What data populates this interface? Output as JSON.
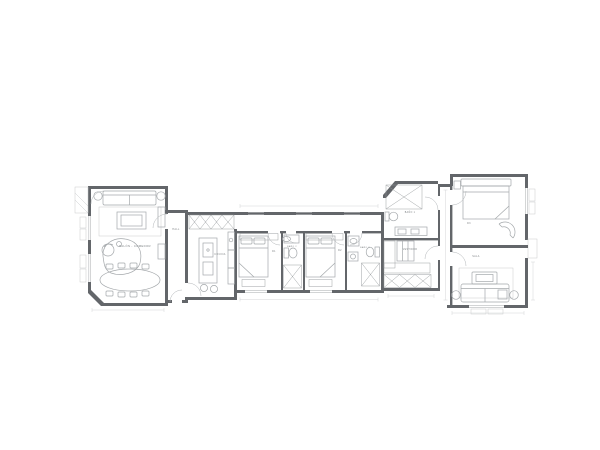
{
  "title": "Apartment floor plan",
  "colors": {
    "background": "#ffffff",
    "wall": "#63666a",
    "furniture_stroke": "#a4a8ab",
    "hatch_stroke": "#94989b",
    "label_text": "#7d8184"
  },
  "rooms": {
    "salon_comedor": "SALÓN - COMEDOR",
    "hall": "HALL",
    "cocina": "COCINA",
    "d1": "D1",
    "bano2": "BAÑO 2",
    "d2": "D2",
    "bano3": "BAÑO 3",
    "bano1": "BAÑO 1",
    "vestidor": "VESTIDOR",
    "d3": "D3",
    "sala": "SALA"
  }
}
